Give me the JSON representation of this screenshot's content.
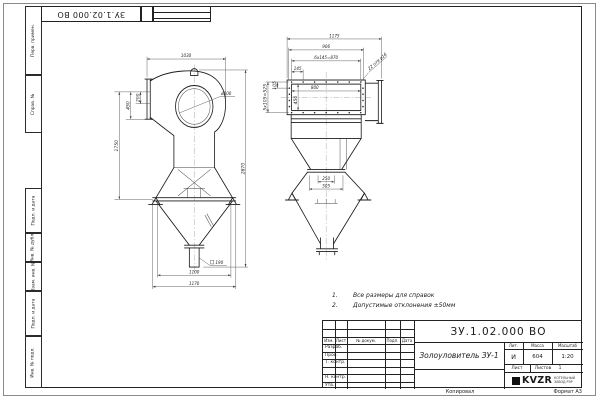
{
  "sheet": {
    "top_stamp": "ЗУ.1.02.000 ВО",
    "margin_labels": [
      "Перв. примен.",
      "Справ. №",
      "Подп. и дата",
      "Инв. № дубл.",
      "Взам. инв. №",
      "Подп. и дата",
      "Инв. № подл."
    ],
    "kopiroval_label": "Копировал",
    "format_label": "Формат А3"
  },
  "notes": {
    "items": [
      {
        "num": "1.",
        "text": "Все размеры для справок"
      },
      {
        "num": "2.",
        "text": "Допустимые отклонения ±50мм"
      }
    ]
  },
  "left_view": {
    "dims": {
      "top_width": "1030",
      "inlet_height": "200",
      "inlet_offset": "450",
      "body_height": "1750",
      "outlet_diameter": "ø500",
      "total_height": "2870",
      "chute_square": "190",
      "hopper_width": "1100",
      "overall_width": "1170"
    }
  },
  "right_view": {
    "dims": {
      "overall_width": "1175",
      "flange_width": "906",
      "bolt_pitch_h": "6x145=870",
      "bolt_first_pitch": "145",
      "holes_note": "22 отв ø16",
      "opening_width": "800",
      "opening_height": "450",
      "bolt_first_pitch_v": "105",
      "bolt_pitch_v": "5x105=525",
      "chute_width": "250",
      "chute_flange_width": "505"
    }
  },
  "title_block": {
    "doc_number": "ЗУ.1.02.000 ВО",
    "product_name": "Золоуловитель ЗУ-1",
    "col_izm": "Изм.",
    "col_list": "Лист",
    "col_docum": "№ докум.",
    "col_podp": "Подп.",
    "col_data": "Дата",
    "row_razrab": "Разраб.",
    "row_prov": "Пров.",
    "row_tkontr": "Т. контр.",
    "row_nkontr": "Н. контр.",
    "row_utv": "Утв.",
    "lit_label": "Лит.",
    "lit_value": "И",
    "massa_label": "Масса",
    "massa_value": "604",
    "masshtab_label": "Масштаб",
    "masshtab_value": "1:20",
    "list_label": "Лист",
    "listov_label": "Листов",
    "listov_value": "1",
    "logo_text": "KVZR",
    "logo_sub1": "КОТЕЛЬНЫЙ",
    "logo_sub2": "ЗАВОД РЭР"
  }
}
